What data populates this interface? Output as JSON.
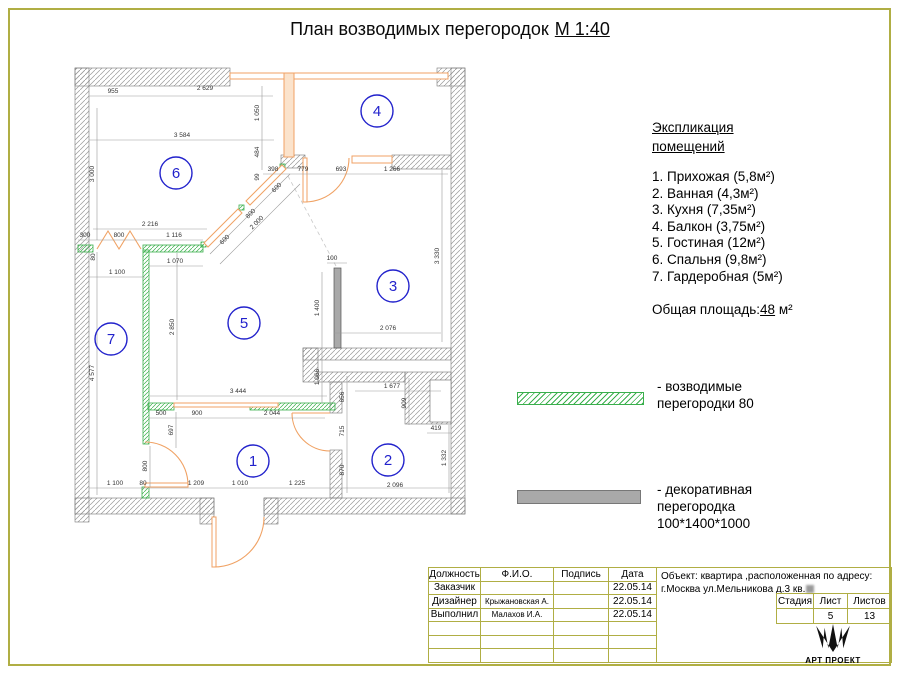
{
  "title": {
    "text": "План возводимых перегородок",
    "scale": "М 1:40"
  },
  "schedule": {
    "heading": [
      "Экспликация",
      "помещений"
    ],
    "items": [
      "1. Прихожая (5,8м²)",
      "2. Ванная (4,3м²)",
      "3. Кухня (7,35м²)",
      "4. Балкон (3,75м²)",
      "5. Гостиная (12м²)",
      "6. Спальня (9,8м²)",
      "7. Гардеробная (5м²)"
    ],
    "total_label": "Общая площадь:",
    "total_value": "48",
    "total_unit": "м²"
  },
  "legend": {
    "new_partitions": {
      "line1": "- возводимые",
      "line2": "перегородки 80"
    },
    "decorative": {
      "line1": "- декоративная",
      "line2": "перегородка",
      "line3": "100*1400*1000"
    }
  },
  "titleblock": {
    "headers": [
      "Должность",
      "Ф.И.О.",
      "Подпись",
      "Дата"
    ],
    "rows": [
      {
        "role": "Заказчик",
        "name": "",
        "sign": "",
        "date": "22.05.14"
      },
      {
        "role": "Дизайнер",
        "name": "Крыжановская А.",
        "sign": "",
        "date": "22.05.14"
      },
      {
        "role": "Выполнил",
        "name": "Малахов И.А.",
        "sign": "",
        "date": "22.05.14"
      },
      {
        "role": "",
        "name": "",
        "sign": "",
        "date": ""
      },
      {
        "role": "",
        "name": "",
        "sign": "",
        "date": ""
      },
      {
        "role": "",
        "name": "",
        "sign": "",
        "date": ""
      }
    ],
    "object_line1": "Объект: квартира ,расположенная по адресу:",
    "object_line2": "г.Москва ул.Мельникова д.3 кв.",
    "stage_headers": [
      "Стадия",
      "Лист",
      "Листов"
    ],
    "stage_values": [
      "",
      "5",
      "13"
    ],
    "logo": "АРТ ПРОЕКТ"
  },
  "plan": {
    "rooms": [
      {
        "n": "1",
        "x": 253,
        "y": 461
      },
      {
        "n": "2",
        "x": 388,
        "y": 460
      },
      {
        "n": "3",
        "x": 393,
        "y": 286
      },
      {
        "n": "4",
        "x": 377,
        "y": 111
      },
      {
        "n": "5",
        "x": 244,
        "y": 323
      },
      {
        "n": "6",
        "x": 176,
        "y": 173
      },
      {
        "n": "7",
        "x": 111,
        "y": 339
      }
    ],
    "dimensions": [
      {
        "t": "955",
        "x": 113,
        "y": 93,
        "r": 0
      },
      {
        "t": "2 629",
        "x": 205,
        "y": 90,
        "r": 0
      },
      {
        "t": "3 584",
        "x": 182,
        "y": 137,
        "r": 0
      },
      {
        "t": "1 050",
        "x": 259,
        "y": 113,
        "r": -90
      },
      {
        "t": "484",
        "x": 259,
        "y": 152,
        "r": -90
      },
      {
        "t": "99",
        "x": 259,
        "y": 177,
        "r": -90
      },
      {
        "t": "3 000",
        "x": 94,
        "y": 174,
        "r": -90
      },
      {
        "t": "398",
        "x": 273,
        "y": 171,
        "r": 0
      },
      {
        "t": "779",
        "x": 303,
        "y": 171,
        "r": 0
      },
      {
        "t": "693",
        "x": 341,
        "y": 171,
        "r": 0
      },
      {
        "t": "1 266",
        "x": 392,
        "y": 171,
        "r": 0
      },
      {
        "t": "3 330",
        "x": 439,
        "y": 256,
        "r": -90
      },
      {
        "t": "600",
        "x": 278,
        "y": 189,
        "r": -45
      },
      {
        "t": "800",
        "x": 252,
        "y": 215,
        "r": -45
      },
      {
        "t": "600",
        "x": 226,
        "y": 241,
        "r": -45
      },
      {
        "t": "2 000",
        "x": 258,
        "y": 224,
        "r": -45
      },
      {
        "t": "2 216",
        "x": 150,
        "y": 226,
        "r": 0
      },
      {
        "t": "300",
        "x": 85,
        "y": 237,
        "r": 0
      },
      {
        "t": "800",
        "x": 119,
        "y": 237,
        "r": 0
      },
      {
        "t": "1 116",
        "x": 174,
        "y": 237,
        "r": 0
      },
      {
        "t": "80",
        "x": 95,
        "y": 257,
        "r": -90
      },
      {
        "t": "1 070",
        "x": 175,
        "y": 263,
        "r": 0
      },
      {
        "t": "1 100",
        "x": 117,
        "y": 274,
        "r": 0
      },
      {
        "t": "2 850",
        "x": 174,
        "y": 327,
        "r": -90
      },
      {
        "t": "4 577",
        "x": 94,
        "y": 373,
        "r": -90
      },
      {
        "t": "100",
        "x": 332,
        "y": 260,
        "r": 0
      },
      {
        "t": "1 400",
        "x": 319,
        "y": 308,
        "r": -90
      },
      {
        "t": "1 066",
        "x": 319,
        "y": 377,
        "r": -90
      },
      {
        "t": "2 076",
        "x": 388,
        "y": 330,
        "r": 0
      },
      {
        "t": "3 444",
        "x": 238,
        "y": 393,
        "r": 0
      },
      {
        "t": "500",
        "x": 161,
        "y": 415,
        "r": 0
      },
      {
        "t": "900",
        "x": 197,
        "y": 415,
        "r": 0
      },
      {
        "t": "2 044",
        "x": 272,
        "y": 415,
        "r": 0
      },
      {
        "t": "697",
        "x": 173,
        "y": 430,
        "r": -90
      },
      {
        "t": "800",
        "x": 147,
        "y": 466,
        "r": -90
      },
      {
        "t": "656",
        "x": 344,
        "y": 397,
        "r": -90
      },
      {
        "t": "1 677",
        "x": 392,
        "y": 388,
        "r": 0
      },
      {
        "t": "909",
        "x": 406,
        "y": 403,
        "r": -90
      },
      {
        "t": "419",
        "x": 436,
        "y": 430,
        "r": 0
      },
      {
        "t": "715",
        "x": 344,
        "y": 431,
        "r": -90
      },
      {
        "t": "870",
        "x": 344,
        "y": 470,
        "r": -90
      },
      {
        "t": "1 332",
        "x": 446,
        "y": 458,
        "r": -90
      },
      {
        "t": "1 100",
        "x": 115,
        "y": 485,
        "r": 0
      },
      {
        "t": "80",
        "x": 143,
        "y": 485,
        "r": 0
      },
      {
        "t": "1 209",
        "x": 196,
        "y": 485,
        "r": 0
      },
      {
        "t": "1 010",
        "x": 240,
        "y": 485,
        "r": 0
      },
      {
        "t": "1 225",
        "x": 297,
        "y": 485,
        "r": 0
      },
      {
        "t": "2 096",
        "x": 395,
        "y": 487,
        "r": 0
      }
    ]
  },
  "colors": {
    "green": "#3aaf4c",
    "orange": "#f0a264",
    "blue": "#2222cc",
    "olive": "#b0ae44",
    "decor": "#a9a9a9",
    "dim": "#9a9a9a"
  }
}
